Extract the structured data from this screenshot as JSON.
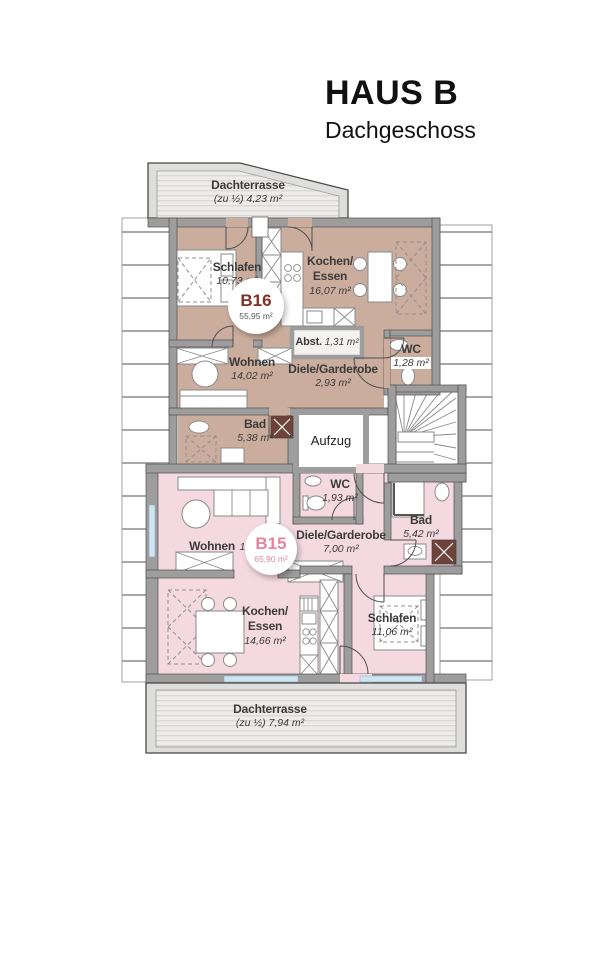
{
  "header": {
    "title": "HAUS B",
    "subtitle": "Dachgeschoss"
  },
  "colors": {
    "b16_fill": "#cbad9d",
    "b15_fill": "#f4d9e1",
    "b16_accent": "#7d3127",
    "b15_accent": "#e5849e",
    "wall": "#9d9d9d",
    "wall_dark": "#4f4f4f",
    "abst_fill": "#f4f2ef",
    "window": "#cfe5f2",
    "shower": "#6f4339",
    "text": "#3b3b3b"
  },
  "terrace_top": {
    "name": "Dachterrasse",
    "area": "(zu ½) 4,23 m²"
  },
  "terrace_bottom": {
    "name": "Dachterrasse",
    "area": "(zu ½) 7,94 m²"
  },
  "b16": {
    "badge_id": "B16",
    "badge_area": "55,95 m²",
    "schlafen": {
      "name": "Schlafen",
      "area": "10,73 m²"
    },
    "kochen": {
      "l1": "Kochen/",
      "l2": "Essen",
      "area": "16,07 m²"
    },
    "abst": {
      "name": "Abst.",
      "area": "1,31 m²"
    },
    "wc": {
      "name": "WC",
      "area": "1,28 m²"
    },
    "wohnen": {
      "name": "Wohnen",
      "area": "14,02 m²"
    },
    "diele": {
      "name": "Diele/Garderobe",
      "area": "2,93 m²"
    },
    "bad": {
      "name": "Bad",
      "area": "5,38 m²"
    }
  },
  "b15": {
    "badge_id": "B15",
    "badge_area": "65,90 m²",
    "wohnen": {
      "name": "Wohnen",
      "area": "17,89 m²"
    },
    "wc": {
      "name": "WC",
      "area": "1,93 m²"
    },
    "diele": {
      "name": "Diele/Garderobe",
      "area": "7,00 m²"
    },
    "bad": {
      "name": "Bad",
      "area": "5,42 m²"
    },
    "kochen": {
      "l1": "Kochen/",
      "l2": "Essen",
      "area": "14,66 m²"
    },
    "schlafen": {
      "name": "Schlafen",
      "area": "11,06 m²"
    }
  },
  "common": {
    "aufzug": "Aufzug"
  }
}
